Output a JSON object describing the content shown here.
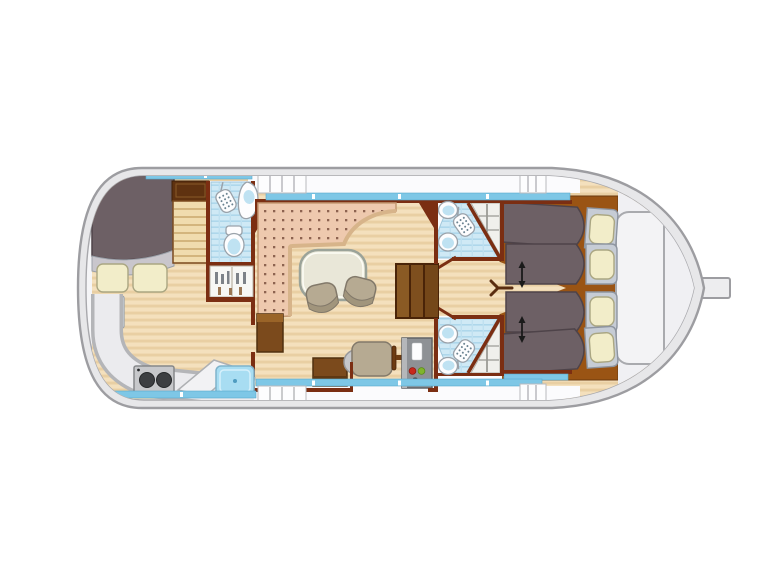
{
  "title": "houseboat-deck-plan",
  "canvas": {
    "width": 768,
    "height": 576
  },
  "colors": {
    "bg": "#ffffff",
    "hull-line": "#9d9da1",
    "hull-band": "#e7e7e9",
    "deck": "#f5f5f7",
    "deck-white": "#fbfbfd",
    "wood-light": "#f4e0bd",
    "wood-dark": "#e9cfa3",
    "wall": "#7b2e12",
    "window": "#7ec7e6",
    "bench": "#eec9ae",
    "bench-dot": "#8d6350",
    "bench-edge": "#c59a74",
    "table": "#e9e7d8",
    "chair": "#b6aa92",
    "blanket": "#6d6065",
    "sheet": "#c9c6cc",
    "bedhead": "#c6ccd5",
    "pillow": "#f2edc9",
    "bedbase": "#9a5414",
    "shower": "#cfe9f5",
    "fixture-blue": "#bfe2f2",
    "snowflake": "#2b9fd6",
    "step-wood": "#8a5a24",
    "cabinet": "#7b4a1c",
    "console": "#8e9195",
    "console-red": "#c8281c",
    "console-green": "#7fb52c",
    "burner": "#3d3f42",
    "sink": "#a8ddf2",
    "arrow": "#1a1a1a"
  },
  "icons": {
    "snowflake_glyph": "❄",
    "shower_head": "shower-head-icon",
    "double_arrow": "berth-slide-arrow"
  },
  "areas": [
    "bow-cabin-double-berth",
    "front-bathroom",
    "saloon-with-galley",
    "helm-station",
    "aft-bathroom-port",
    "aft-bathroom-starboard",
    "aft-cabin-four-berths",
    "side-deck-walkways",
    "stern-rudder"
  ],
  "counts": {
    "single_berths_aft": 4,
    "double_berths_bow": 1,
    "bathrooms": 3
  }
}
